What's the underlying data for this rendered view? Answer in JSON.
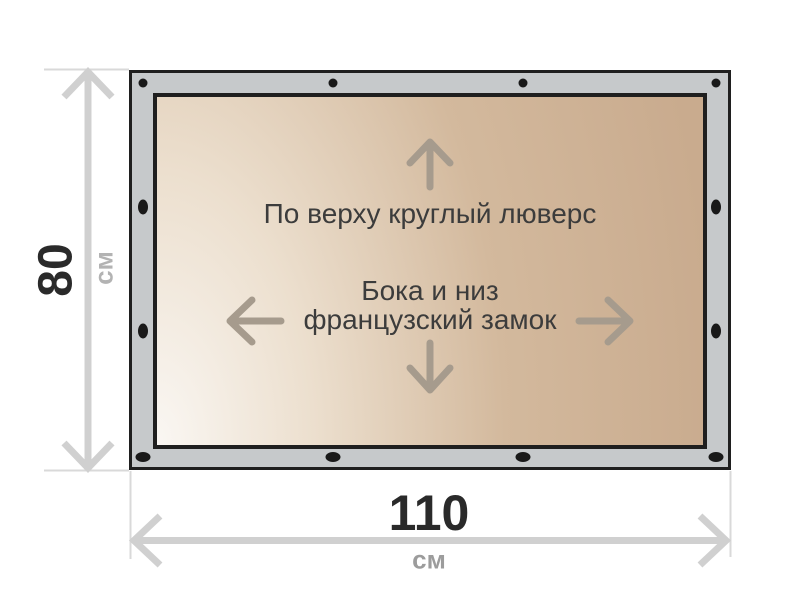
{
  "diagram": {
    "notes": {
      "top": "По верху круглый люверс",
      "center_line1": "Бока и низ",
      "center_line2": "французский замок"
    },
    "dimensions": {
      "height": {
        "value": "80",
        "unit": "см"
      },
      "width": {
        "value": "110",
        "unit": "см"
      }
    },
    "icons": {
      "grommet": "grommet-dot-icon",
      "direction_arrows": [
        "arrow-up-icon",
        "arrow-left-icon",
        "arrow-right-icon",
        "arrow-down-icon"
      ],
      "dimension_arrows": [
        "height-dimension-arrow",
        "width-dimension-arrow"
      ]
    },
    "colors": {
      "background": "#ffffff",
      "frame_fill": "#c6c9cb",
      "frame_border": "#1f1f1f",
      "canvas_gradient_light": "#faf7f3",
      "canvas_gradient_dark": "#c9ab8e",
      "note_text": "#3c3c3c",
      "direction_arrow": "#a69b8d",
      "dimension_arrow": "#d0d0d0",
      "dimension_value": "#2a2a2a",
      "dimension_unit": "#a8a8a8",
      "grommet": "#191919"
    }
  }
}
